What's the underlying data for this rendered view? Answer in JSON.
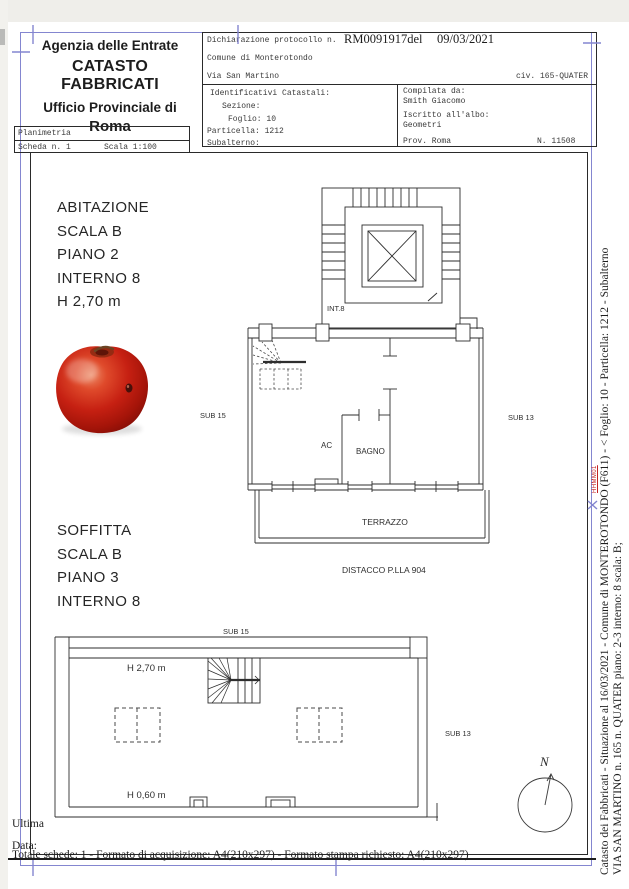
{
  "header": {
    "agency": {
      "line1": "Agenzia delle Entrate",
      "line2": "CATASTO FABBRICATI",
      "line3": "Ufficio Provinciale di",
      "line4": "Roma"
    },
    "protocol": {
      "declaration_label": "Dichiarazione protocollo n.",
      "protocol_number": "RM0091917del",
      "protocol_date": "09/03/2021",
      "comune": "Comune di Monterotondo",
      "street": "Via San Martino",
      "civic": "civ. 165-QUATER",
      "identificativi_title": "Identificativi Catastali:",
      "sezione_label": "Sezione:",
      "foglio": "Foglio: 10",
      "particella": "Particella: 1212",
      "subalterno_label": "Subalterno:",
      "compilata_label": "Compilata da:",
      "compilata_name": "Smith Giacomo",
      "albo_label": "Iscritto all'albo:",
      "albo_value": "Geometri",
      "prov": "Prov. Roma",
      "albo_number": "N. 11508"
    },
    "planimetria": {
      "title": "Planimetria",
      "scheda": "Scheda n. 1",
      "scala": "Scala 1:100"
    }
  },
  "drawing": {
    "unit1": {
      "lines": [
        "ABITAZIONE",
        "SCALA B",
        "PIANO 2",
        "INTERNO 8",
        "H 2,70 m"
      ]
    },
    "unit2": {
      "lines": [
        "SOFFITTA",
        "SCALA B",
        "PIANO 3",
        "INTERNO 8"
      ]
    },
    "plan_labels": {
      "int8": "INT.8",
      "sub15": "SUB 15",
      "sub13": "SUB 13",
      "ac": "AC",
      "bagno": "BAGNO",
      "terrazzo": "TERRAZZO",
      "distacco": "DISTACCO P.LLA 904"
    },
    "attic_labels": {
      "sub15": "SUB 15",
      "sub13": "SUB 13",
      "h_top": "H 2,70 m",
      "h_bottom": "H 0,60 m"
    },
    "compass_label": "N"
  },
  "sidebar": {
    "line1": "Catasto dei Fabbricati - Situazione al 16/03/2021 - Comune di MONTEROTONDO (F611) - < Foglio: 10 - Particella: 1212 - Subalterno",
    "line2": "VIA SAN MARTINO n. 165 n. QUATER piano: 2-3 interno: 8 scala: B;",
    "stamp": "HHMM01"
  },
  "footer": {
    "ultima": "Ultima",
    "data_label": "Data:",
    "totale": "Totale schede: 1 - Formato di acquisizione: A4(210x297)  - Formato stampa richiesto: A4(210x297)"
  },
  "colors": {
    "frame_blue": "#8486d0",
    "line_black": "#2e2e2e",
    "stamp_red": "#c32222"
  }
}
